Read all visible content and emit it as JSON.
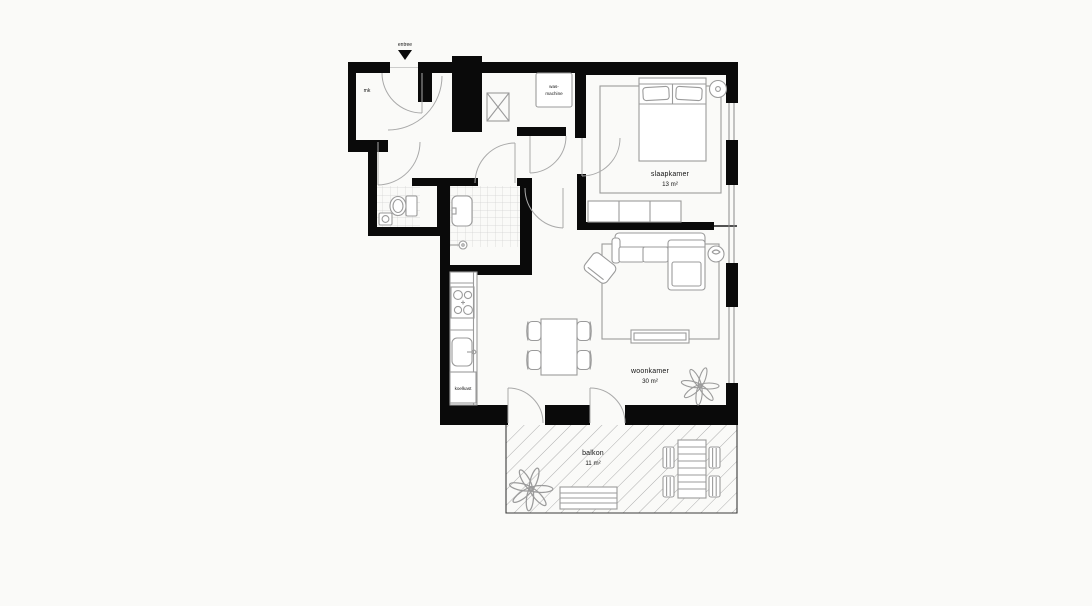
{
  "plan": {
    "title": "apartment floor plan",
    "theme": {
      "background": "#fafaf8",
      "wall": "#0a0a0a",
      "furniture": "#9b9b9b",
      "tile": "#d2d2d2",
      "hatch": "#9a9a9a",
      "text": "#141414"
    },
    "entrance": {
      "label": "entree"
    },
    "meter_cupboard": {
      "label": "mk"
    },
    "laundry": {
      "washing_machine_line1": "was-",
      "washing_machine_line2": "machine"
    },
    "bedroom": {
      "name": "slaapkamer",
      "area": "13 m²"
    },
    "living_room": {
      "name": "woonkamer",
      "area": "30 m²"
    },
    "kitchen": {
      "fridge_label": "koelkast"
    },
    "balcony": {
      "name": "balkon",
      "area": "11 m²"
    }
  }
}
